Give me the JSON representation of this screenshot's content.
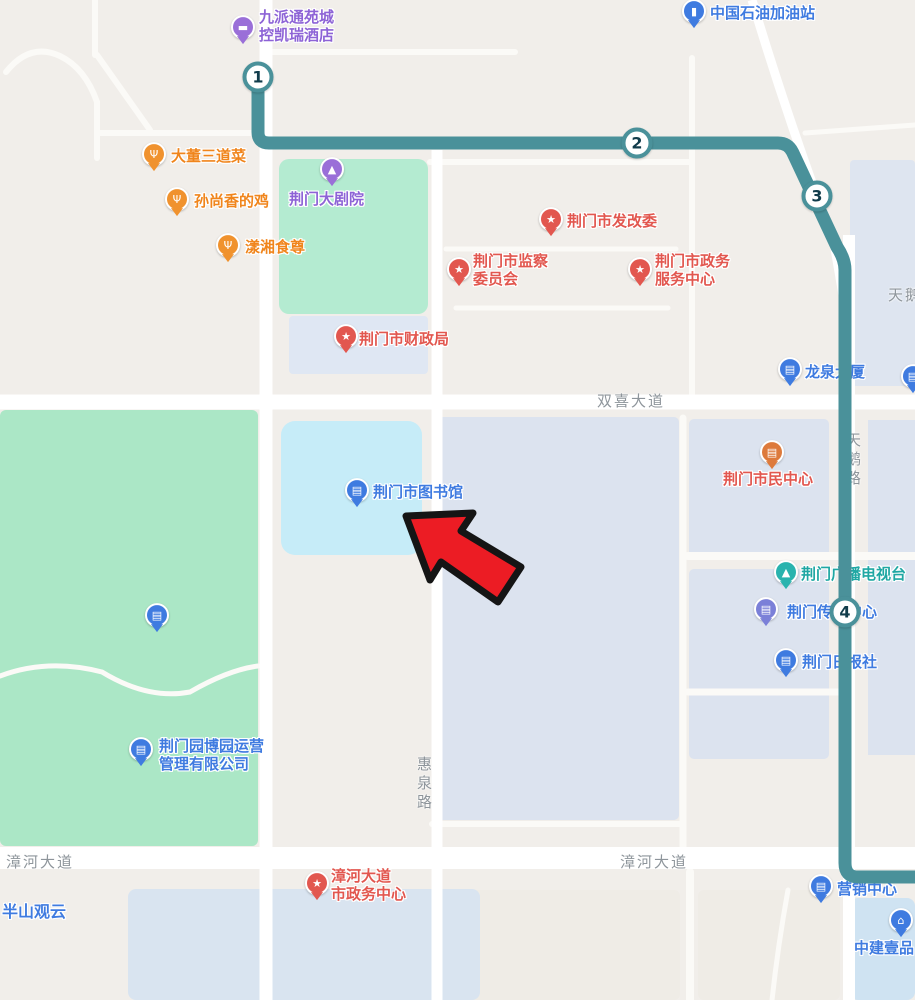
{
  "theme": {
    "background": "#f1eeea",
    "road_fill": "#ffffff",
    "block_fill": "#dce3ef",
    "park_fill": "#abe7c6",
    "water_fill": "#c6ecf8",
    "route_color": "#4a919a",
    "road_label_color": "#8e959b",
    "arrow_fill": "#ec1c24",
    "arrow_outline": "#151515",
    "poi_colors": {
      "blue": "#3f7be0",
      "red": "#e2574f",
      "orange": "#f0922e",
      "purple": "#9a6fd8",
      "teal": "#29b3ae",
      "slate": "#7b80d8",
      "amber": "#dd7a3c"
    }
  },
  "icons": {
    "bed": "▬",
    "fuel": "▮",
    "restaurant": "Ψ",
    "theater": "▲",
    "star": "★",
    "building": "▤",
    "book": "▤",
    "antenna": "▲",
    "document": "▤",
    "home": "⌂"
  },
  "route": {
    "waypoints": [
      {
        "n": "1"
      },
      {
        "n": "2"
      },
      {
        "n": "3"
      },
      {
        "n": "4"
      }
    ]
  },
  "road_labels": [
    {
      "text": "双喜大道"
    },
    {
      "text": "天鹅路"
    },
    {
      "text": "惠泉路"
    },
    {
      "text": "漳河大道"
    },
    {
      "text": "漳河大道"
    },
    {
      "text": "天鹅"
    }
  ],
  "pois": [
    {
      "lines": [
        "九派通苑城",
        "控凯瑞酒店"
      ]
    },
    {
      "label": "中国石油加油站"
    },
    {
      "label": "大董三道菜"
    },
    {
      "label": "孙尚香的鸡"
    },
    {
      "label": "漾湘食尊"
    },
    {
      "label": "荆门大剧院"
    },
    {
      "label": "荆门市发改委"
    },
    {
      "lines": [
        "荆门市监察",
        "委员会"
      ]
    },
    {
      "lines": [
        "荆门市政务",
        "服务中心"
      ]
    },
    {
      "label": "荆门市财政局"
    },
    {
      "label": "龙泉大厦"
    },
    {
      "label": "荆门市民中心"
    },
    {
      "label": "荆门市图书馆"
    },
    {
      "label": "荆门广播电视台"
    },
    {
      "label": "荆门传媒中心"
    },
    {
      "label": "荆门日报社"
    },
    {
      "lines": [
        "荆门园博园运营",
        "管理有限公司"
      ]
    },
    {
      "label": ""
    },
    {
      "lines": [
        "漳河大道",
        "市政务中心"
      ]
    },
    {
      "label": "营销中心"
    },
    {
      "label": "中建壹品"
    },
    {
      "label": "半山观云"
    },
    {
      "label": ""
    }
  ]
}
